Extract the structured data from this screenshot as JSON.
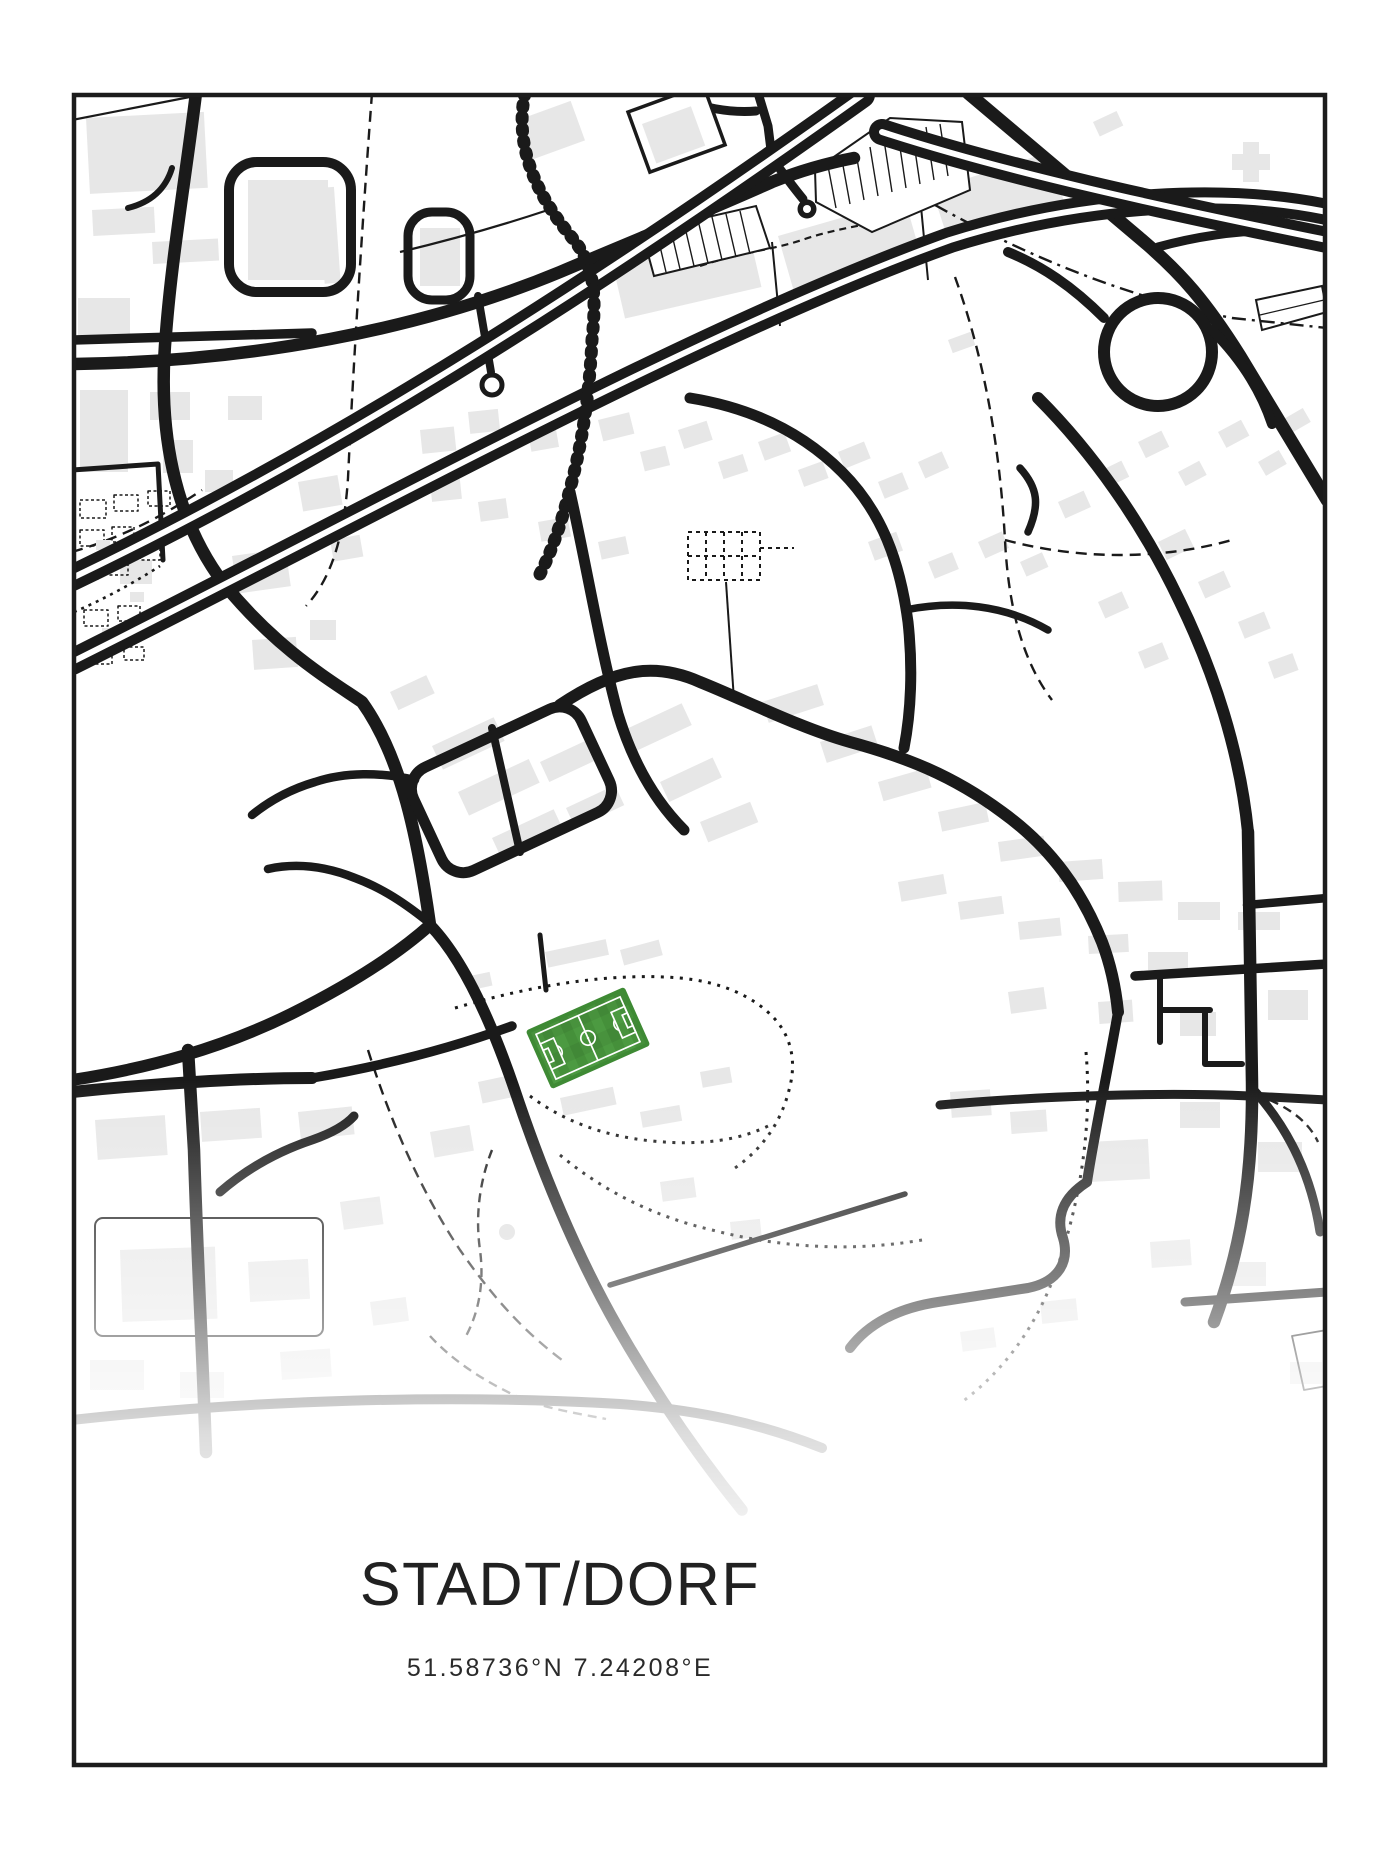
{
  "poster": {
    "title": "STADT/DORF",
    "coordinates": "51.58736°N 7.24208°E",
    "latitude": "51.58736°N",
    "longitude": "7.24208°E"
  },
  "map": {
    "kind": "minimalist stadium street map poster",
    "features": {
      "stadium_marker": "football-pitch",
      "road_color_note": "black roads on white, light gray buildings, map fades to white above title"
    },
    "colors": {
      "ink": "#1a1a1a",
      "building": "#e7e7e7",
      "pitch_green": "#4c9a41",
      "pitch_green_dark": "#45903a",
      "pitch_trim": "#3e8a34",
      "background": "#ffffff",
      "text": "#212121"
    }
  }
}
